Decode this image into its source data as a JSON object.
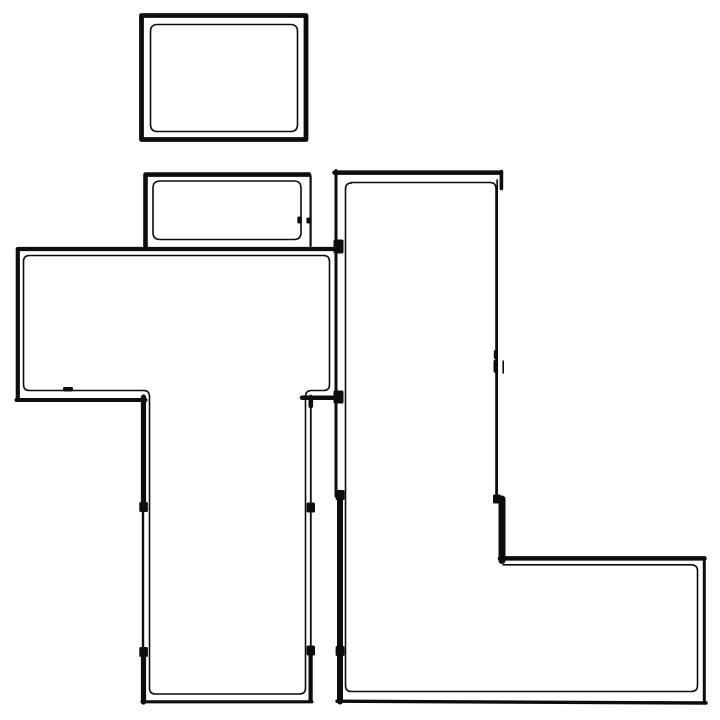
{
  "floor_plan": {
    "canvas": {
      "width": 720,
      "height": 720
    },
    "colors": {
      "background": "#ffffff",
      "wall": "#0d0d0d"
    },
    "rooms": [
      {
        "name": "top-room",
        "bbox": [
          141,
          15,
          306,
          140
        ]
      },
      {
        "name": "mid-room",
        "bbox": [
          144,
          173,
          312,
          247
        ]
      },
      {
        "name": "left-room",
        "bbox": [
          17,
          247,
          337,
          400
        ]
      },
      {
        "name": "hall-room",
        "bbox": [
          142,
          398,
          312,
          702
        ]
      },
      {
        "name": "l-shaped-room",
        "bbox": [
          335,
          171,
          705,
          703
        ]
      }
    ],
    "outer_walls": [
      {
        "name": "top-room-outer",
        "d": "M 141.5,15.5 H 306 V 139.5 H 141.5 Z",
        "w": 4.8
      },
      {
        "name": "mid-room-left-top-outer",
        "d": "M 145.5,247 V 174.6 H 309",
        "w": 4.6
      },
      {
        "name": "mid-room-right-outer",
        "d": "M 310.6,176 V 246",
        "w": 2.2
      },
      {
        "name": "left-room-top-left-outer",
        "d": "M 337,249 H 17.8 V 398.5",
        "w": 4.2
      },
      {
        "name": "left-room-bottom-outer",
        "d": "M 16.5,400 H 145.5",
        "w": 4.0
      },
      {
        "name": "hall-left-wall-base",
        "d": "M 143,398 V 702",
        "w": 2.4
      },
      {
        "name": "hall-left-wall-upper",
        "d": "M 143.5,397 V 508",
        "w": 5.2
      },
      {
        "name": "hall-left-wall-lower",
        "d": "M 143.5,651.5 V 702",
        "w": 5.2
      },
      {
        "name": "hall-bottom-wall",
        "d": "M 142,701.8 H 312",
        "w": 3.1
      },
      {
        "name": "hall-right-wall-base",
        "d": "M 310.8,399 V 700",
        "w": 1.8
      },
      {
        "name": "hall-right-wall-stub",
        "d": "M 310.8,397 V 406",
        "w": 4.6
      },
      {
        "name": "hall-right-wall-lower",
        "d": "M 310.6,650.5 V 700.5",
        "w": 4.2
      },
      {
        "name": "hall-right-jog-wall",
        "d": "M 302,397.7 H 338",
        "w": 4.5
      },
      {
        "name": "l-room-left-wall-upper",
        "d": "M 336,170.5 V 496",
        "w": 3.0
      },
      {
        "name": "l-room-left-wall-lower",
        "d": "M 340,494 V 701.5",
        "w": 6.0
      },
      {
        "name": "l-room-top-wall",
        "d": "M 334.5,172.6 H 501",
        "w": 4.5
      },
      {
        "name": "l-room-top-right-tick",
        "d": "M 501.4,171.5 V 188.5",
        "w": 3.6
      },
      {
        "name": "l-room-right-wall-thin",
        "d": "M 497.2,180 V 501",
        "w": 1.7
      },
      {
        "name": "l-room-window-tick-a",
        "d": "M 495.3,351.5 V 357.5",
        "w": 3.0
      },
      {
        "name": "l-room-window-tick-b",
        "d": "M 495.3,361.5 V 371",
        "w": 3.6
      },
      {
        "name": "l-room-window-tick-c",
        "d": "M 503.2,361 V 373",
        "w": 1.6
      },
      {
        "name": "l-room-step-wall",
        "d": "M 502,499 V 560.5",
        "w": 7.0
      },
      {
        "name": "l-room-ext-top-wall",
        "d": "M 500,558.4 H 704.5",
        "w": 4.5
      },
      {
        "name": "l-room-ext-right-wall",
        "d": "M 704.3,558 V 701.5",
        "w": 3.0
      },
      {
        "name": "l-room-bottom-wall",
        "d": "M 337,701.2 L 706,703",
        "w": 3.4
      }
    ],
    "inner_lines": [
      {
        "name": "top-room-inner",
        "d": "M 157.5,24.5 H 290.5 Q 297.5,24.5 297.5,31.5 V 124.5 Q 297.5,131.5 290.5,131.5 H 157.5 Q 150.5,131.5 150.5,124.5 V 31.5 Q 150.5,24.5 157.5,24.5 Z",
        "w": 1.6
      },
      {
        "name": "mid-room-inner",
        "d": "M 160,181 H 294 Q 301,181 301,188 V 232.5 Q 301,239.5 294,239.5 H 160 Q 153,239.5 153,232.5 V 188 Q 153,181 160,181 Z",
        "w": 1.6
      },
      {
        "name": "left-room-hall-inner",
        "d": "M 29.5,255.5 H 323.5 Q 329.5,255.5 329.5,261.5 V 384.5 Q 329.5,390.5 323.5,390.5 H 311.5 Q 305.5,390.5 305.5,396.5 V 688 Q 305.5,694 299.5,694 H 155.5 Q 149.5,694 149.5,688 V 396.5 Q 149.5,390.5 143.5,390.5 H 29.5 Q 23.5,390.5 23.5,384.5 V 261.5 Q 23.5,255.5 29.5,255.5 Z",
        "w": 1.6
      },
      {
        "name": "l-room-inner-upper",
        "d": "M 351,182.5 H 490 Q 496,182.5 496,188.5 V 500",
        "w": 1.6
      },
      {
        "name": "l-room-inner-main",
        "d": "M 503,564.8 H 691 Q 697.5,564.8 697.5,570.8 V 685.5 Q 697.5,691.5 691,691.5 H 351.5 Q 345.5,691.5 345.5,685.5 V 189 Q 345.5,183 351.5,183",
        "w": 1.6
      }
    ],
    "door_marks": [
      {
        "name": "door-jamb-hall-left-upper",
        "x": 139.3,
        "y": 502,
        "w": 8.6,
        "h": 10
      },
      {
        "name": "door-jamb-hall-left-lower",
        "x": 139.3,
        "y": 647,
        "w": 8.6,
        "h": 10
      },
      {
        "name": "door-jamb-hall-right-upper",
        "x": 306.6,
        "y": 502.5,
        "w": 8.4,
        "h": 10
      },
      {
        "name": "door-jamb-hall-right-lower",
        "x": 306.6,
        "y": 645.5,
        "w": 8.4,
        "h": 10
      },
      {
        "name": "door-jamb-l-room-left-upper",
        "x": 335.6,
        "y": 490,
        "w": 9,
        "h": 10
      },
      {
        "name": "door-jamb-l-room-left-lower",
        "x": 335.6,
        "y": 646,
        "w": 9,
        "h": 10
      },
      {
        "name": "junction-left-room-l-room",
        "x": 333.5,
        "y": 239.5,
        "w": 10,
        "h": 14
      },
      {
        "name": "junction-jog-l-room",
        "x": 333.5,
        "y": 390.5,
        "w": 10,
        "h": 13
      },
      {
        "name": "door-tick-left-room-bottom",
        "x": 63,
        "y": 387,
        "w": 10,
        "h": 4.5
      },
      {
        "name": "door-tick-mid-room-a",
        "x": 297.3,
        "y": 216.5,
        "w": 4.6,
        "h": 7
      },
      {
        "name": "door-tick-mid-room-b",
        "x": 306.4,
        "y": 217.5,
        "w": 4,
        "h": 6
      },
      {
        "name": "door-jamb-l-room-right",
        "x": 493,
        "y": 494.5,
        "w": 8,
        "h": 9
      }
    ]
  }
}
